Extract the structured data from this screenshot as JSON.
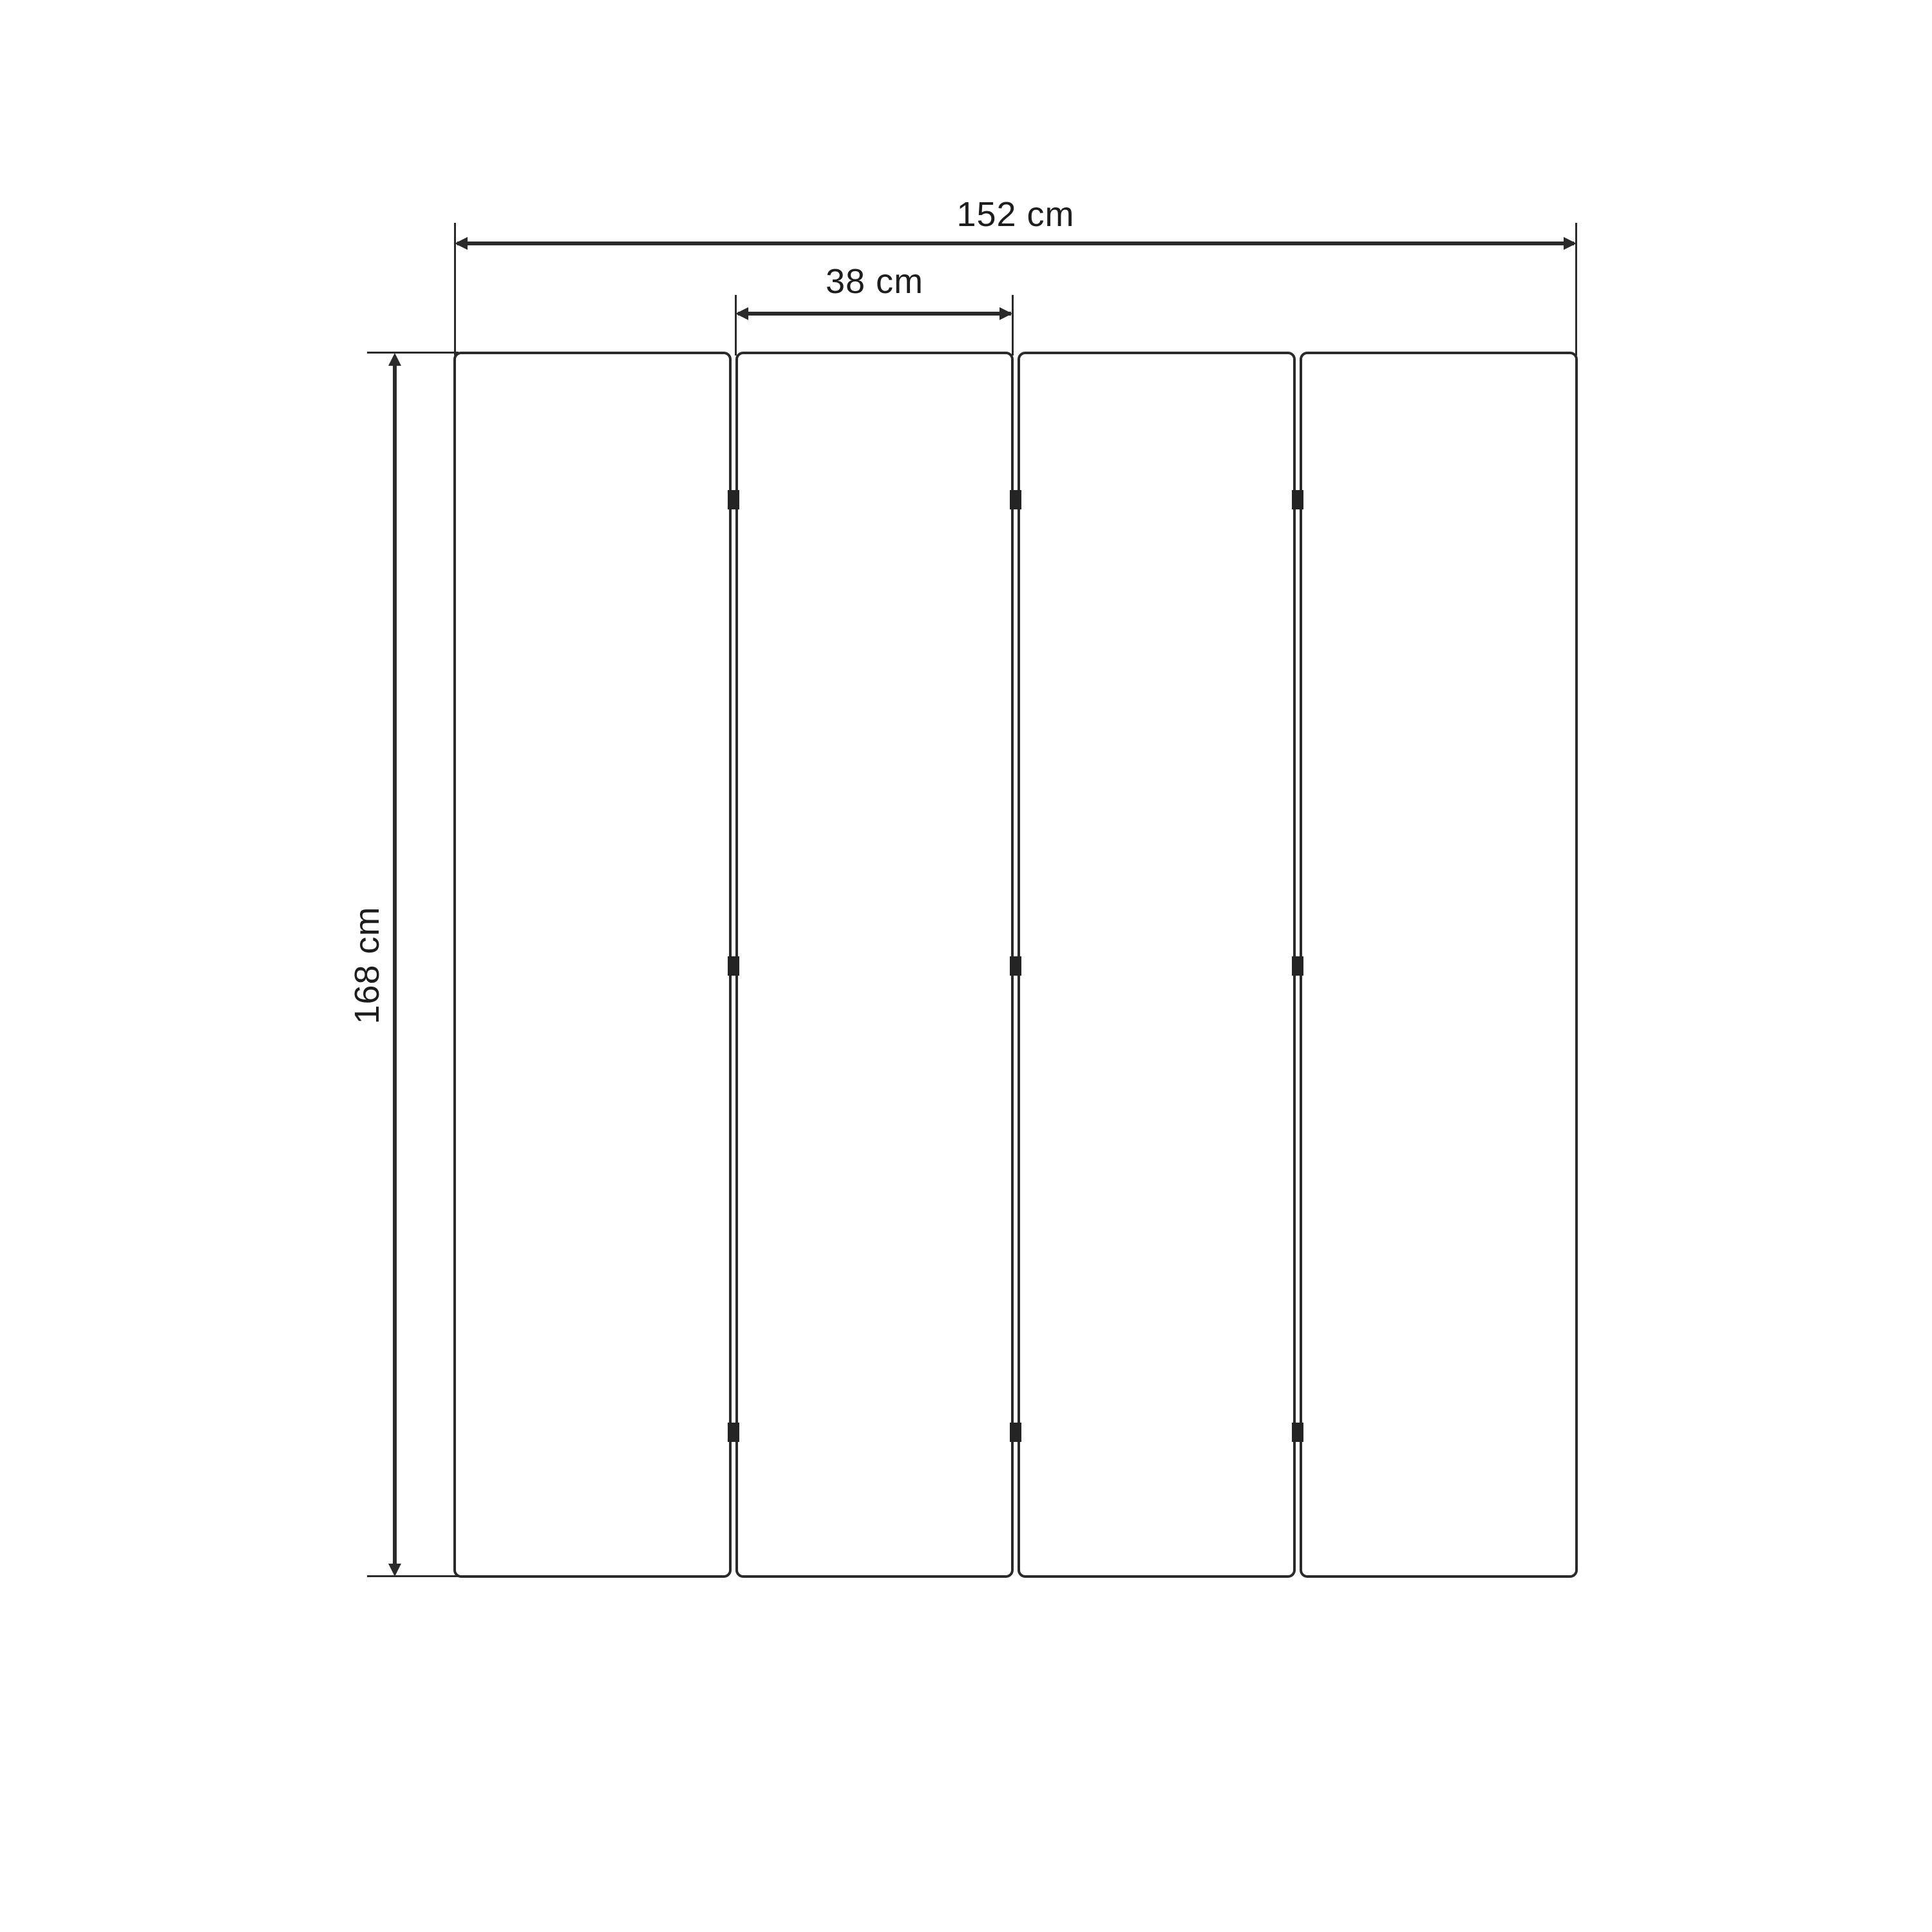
{
  "diagram": {
    "kind": "dimension-drawing",
    "background_color": "#ffffff",
    "line_color": "#2a2a2a",
    "text_color": "#1d1d1d",
    "panel_count": 4,
    "hinge_rows_per_gap": 3
  },
  "dimensions": {
    "total_width": {
      "label": "152 cm",
      "value": 152,
      "unit": "cm"
    },
    "panel_width": {
      "label": "38 cm",
      "value": 38,
      "unit": "cm"
    },
    "height": {
      "label": "168 cm",
      "value": 168,
      "unit": "cm"
    }
  }
}
